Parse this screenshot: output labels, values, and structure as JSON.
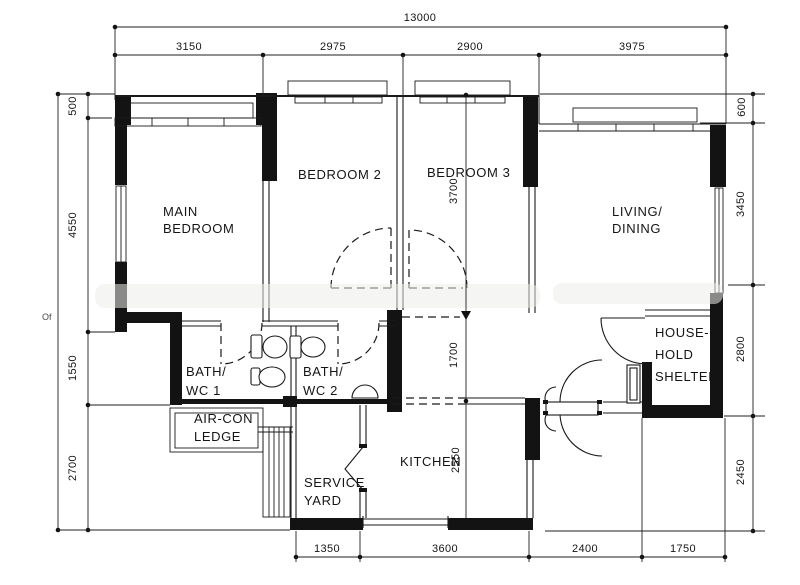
{
  "plan": {
    "type": "floor-plan",
    "units": "mm"
  },
  "rooms": {
    "main_bedroom": [
      "MAIN",
      "BEDROOM"
    ],
    "bedroom_2": [
      "BEDROOM 2"
    ],
    "bedroom_3": [
      "BEDROOM 3"
    ],
    "living_dining": [
      "LIVING/",
      "DINING"
    ],
    "bath_wc_1": [
      "BATH/",
      "WC 1"
    ],
    "bath_wc_2": [
      "BATH/",
      "WC 2"
    ],
    "air_con_ledge": [
      "AIR-CON",
      "LEDGE"
    ],
    "service_yard": [
      "SERVICE",
      "YARD"
    ],
    "kitchen": [
      "KITCHEN"
    ],
    "household_shelter": [
      "HOUSE-",
      "HOLD",
      "SHELTER"
    ]
  },
  "dims": {
    "total_width": "13000",
    "top": [
      "3150",
      "2975",
      "2900",
      "3975"
    ],
    "left": [
      "500",
      "4550",
      "1550",
      "2700"
    ],
    "right": [
      "600",
      "3450",
      "2800",
      "2450"
    ],
    "bottom": [
      "1350",
      "3600",
      "2400",
      "1750"
    ],
    "interior": [
      "3700",
      "1700",
      "2550"
    ]
  },
  "artifact_text": "Of",
  "colors": {
    "ink": "#151515",
    "paper": "#ffffff"
  }
}
